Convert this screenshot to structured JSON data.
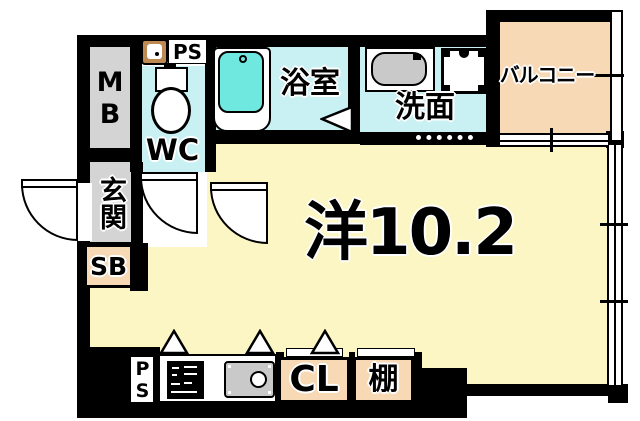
{
  "floorplan": {
    "type": "apartment-floor-plan",
    "main_room": {
      "label": "洋10.2"
    },
    "rooms": {
      "meter_box": "MB",
      "pipe_space_top": "PS",
      "toilet": "WC",
      "bathroom": "浴室",
      "washroom": "洗面",
      "balcony": "バルコニー",
      "entrance": "玄関",
      "shoe_box": "SB",
      "pipe_space_bottom": "PS",
      "closet": "CL",
      "shelf": "棚"
    },
    "colors": {
      "wall": "#000000",
      "main_room_floor": "#FBF6C4",
      "wet_area_floor": "#C9F0F2",
      "bathtub_water": "#6FE8E0",
      "balcony_floor": "#F8D9B6",
      "utility_gray": "#D4D4D4",
      "hand_basin_tan": "#BD8A52"
    }
  }
}
